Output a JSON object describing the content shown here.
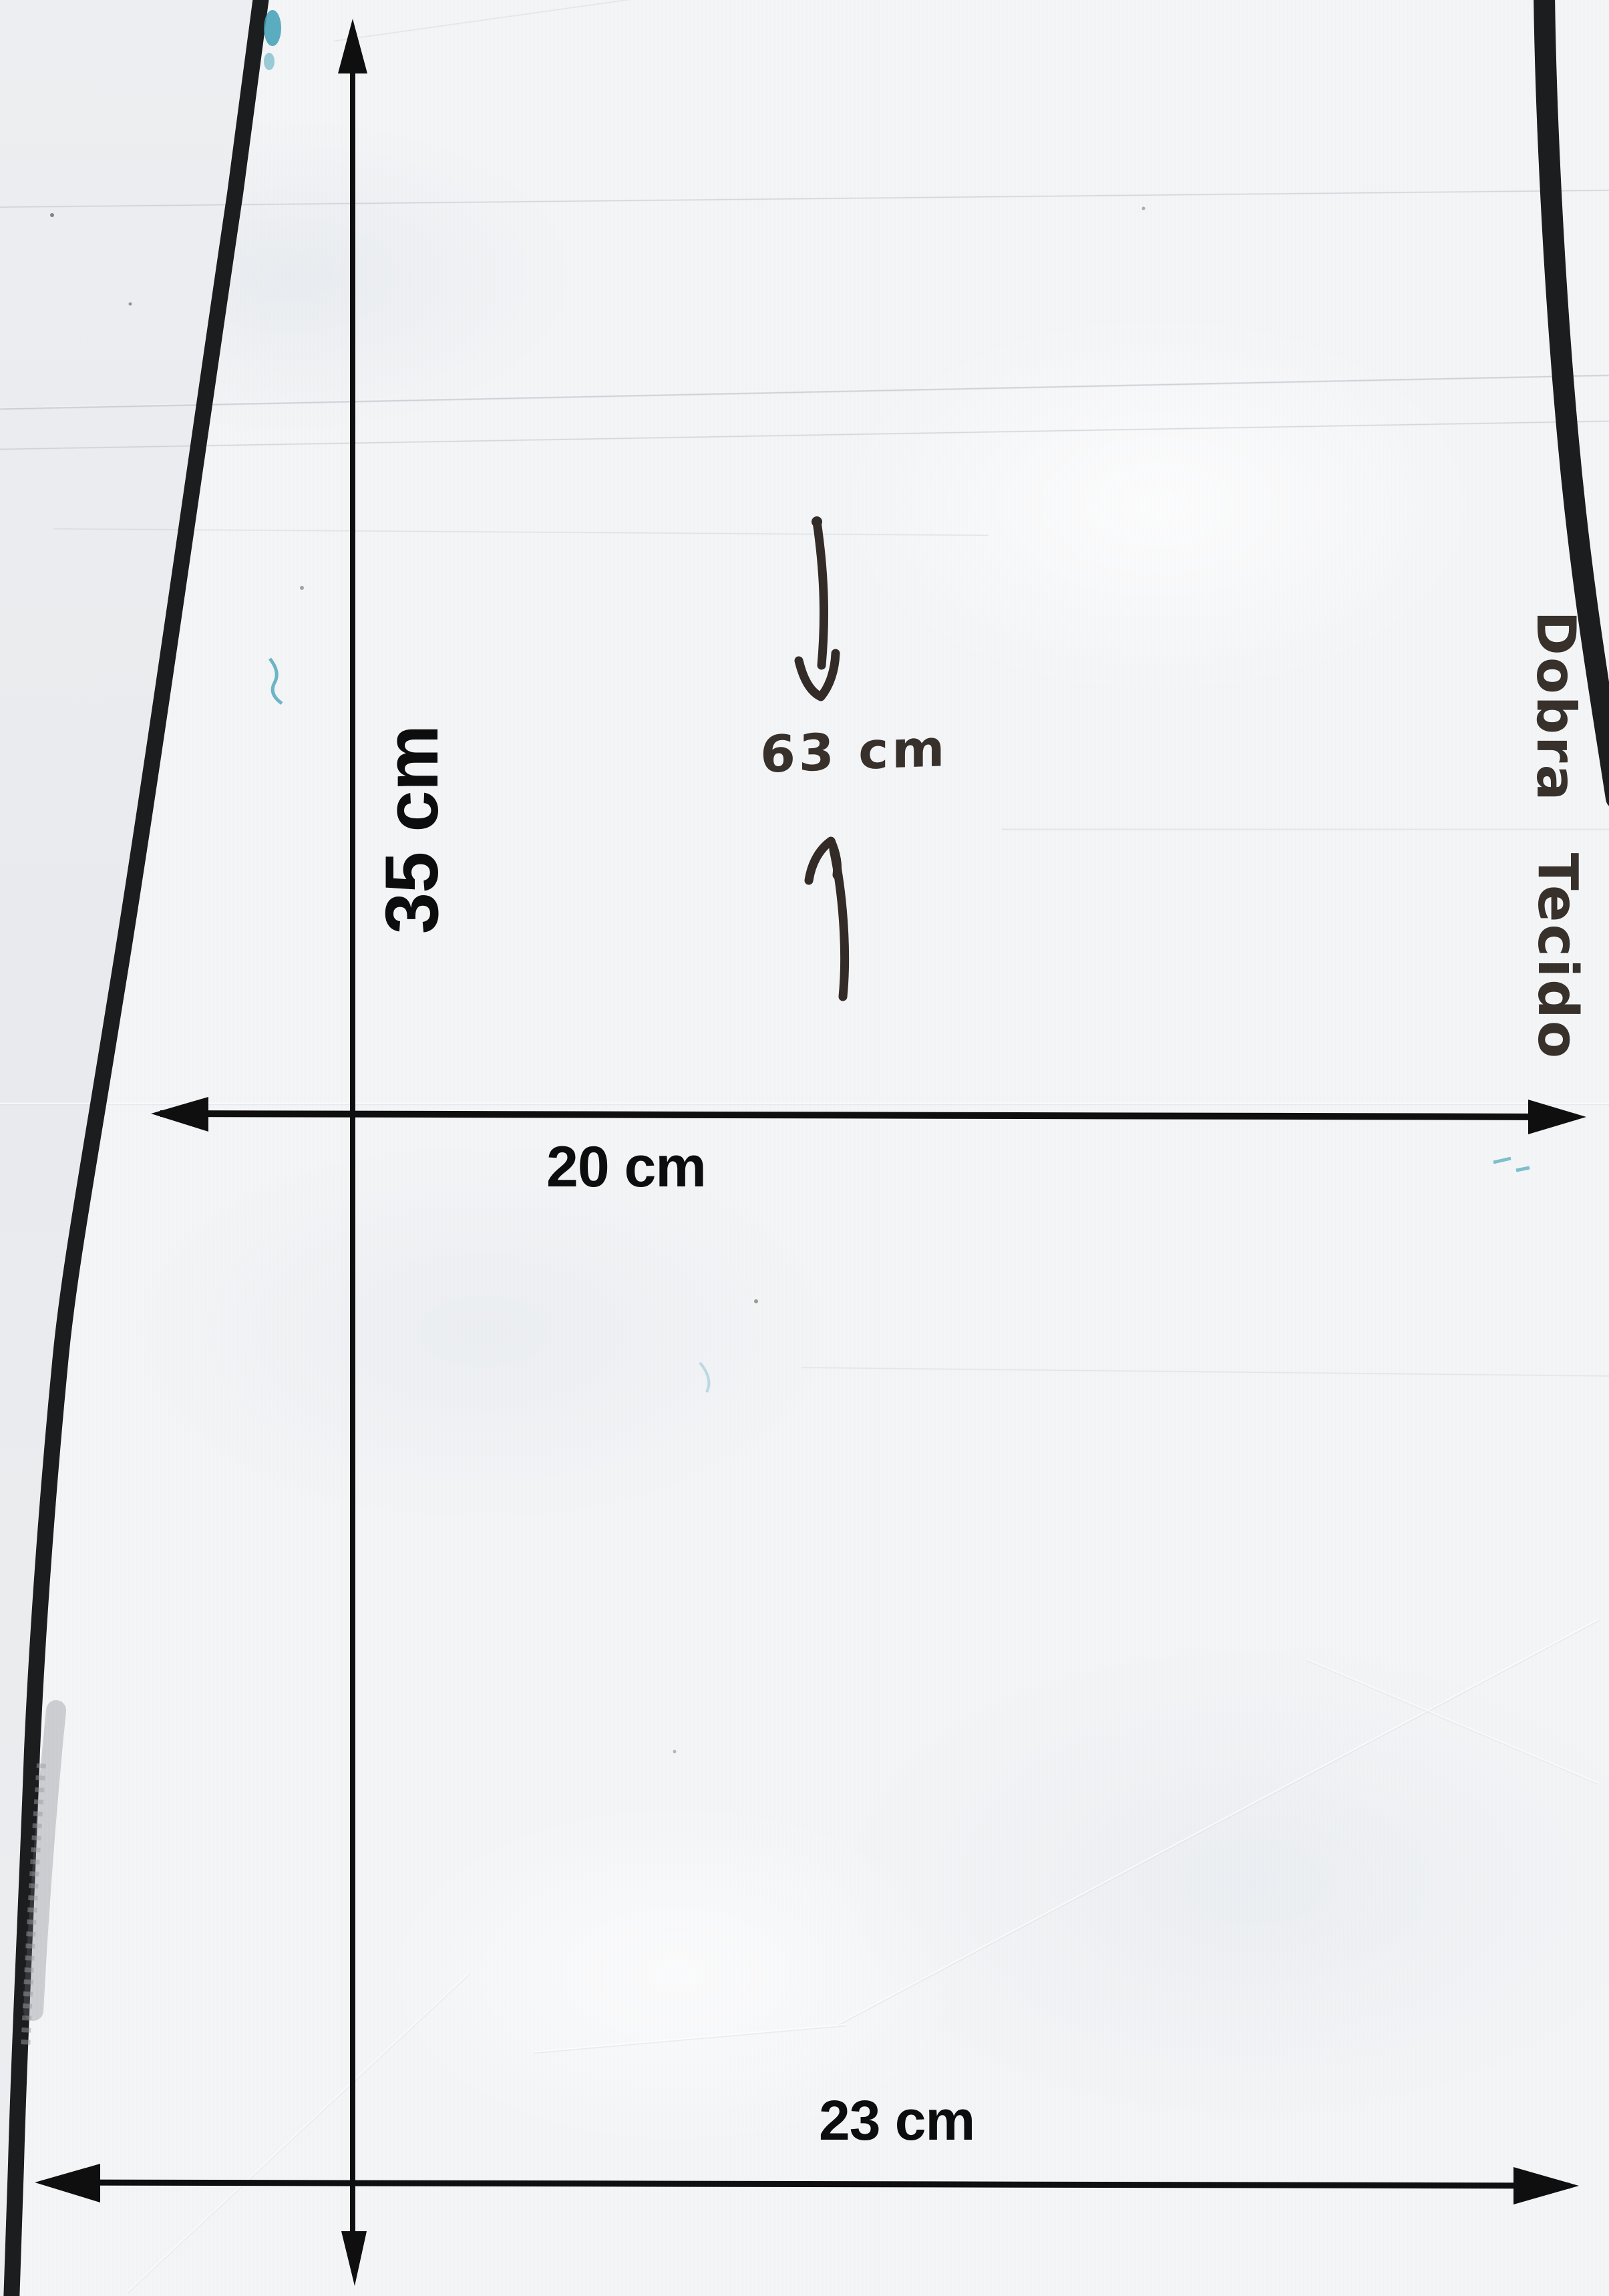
{
  "pattern_scan": {
    "dimension_labels": {
      "vertical": "35 cm",
      "middle_width": "20 cm",
      "bottom_width": "23 cm",
      "handwritten_length": "63 cm"
    },
    "fold_note": {
      "line1": "Dobra",
      "line2": "Tecido"
    },
    "colors": {
      "paper": "#f4f5f7",
      "scanner_background": "#e8eaed",
      "dimension_ink": "#0f0f10",
      "fabric_edge_marker": "#1c1d1f",
      "handwriting_ink": "#37302b",
      "ballpoint_teal": "#3f9fb5"
    }
  }
}
